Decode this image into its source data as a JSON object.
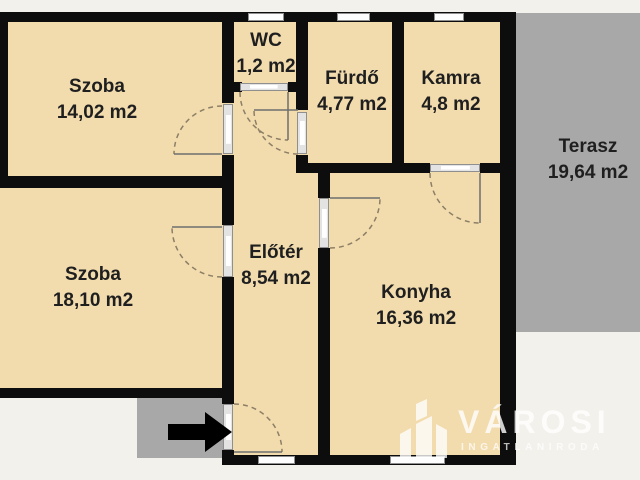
{
  "rooms": [
    {
      "id": "szoba-1",
      "name": "Szoba",
      "area": "14,02 m2"
    },
    {
      "id": "wc",
      "name": "WC",
      "area": "1,2 m2"
    },
    {
      "id": "furdo",
      "name": "Fürdő",
      "area": "4,77 m2"
    },
    {
      "id": "kamra",
      "name": "Kamra",
      "area": "4,8 m2"
    },
    {
      "id": "terasz",
      "name": "Terasz",
      "area": "19,64 m2"
    },
    {
      "id": "szoba-2",
      "name": "Szoba",
      "area": "18,10 m2"
    },
    {
      "id": "eloter",
      "name": "Előtér",
      "area": "8,54 m2"
    },
    {
      "id": "konyha",
      "name": "Konyha",
      "area": "16,36 m2"
    }
  ],
  "brand": {
    "name": "VÁROSI",
    "tagline": "INGATLANIRODA"
  },
  "icons": {
    "entrance_arrow": "right-arrow",
    "logo_mark": "building-towers"
  },
  "colors": {
    "wall": "#0d0d0d",
    "room_fill": "#f2dcae",
    "outdoor_fill": "#a8a8a8",
    "background": "#f2f1ec",
    "door_frame": "#8f8f8f",
    "swing_arc": "#8c7f66",
    "label_text": "#1f1f1f",
    "logo_watermark": "rgba(255,255,255,0.8)"
  }
}
